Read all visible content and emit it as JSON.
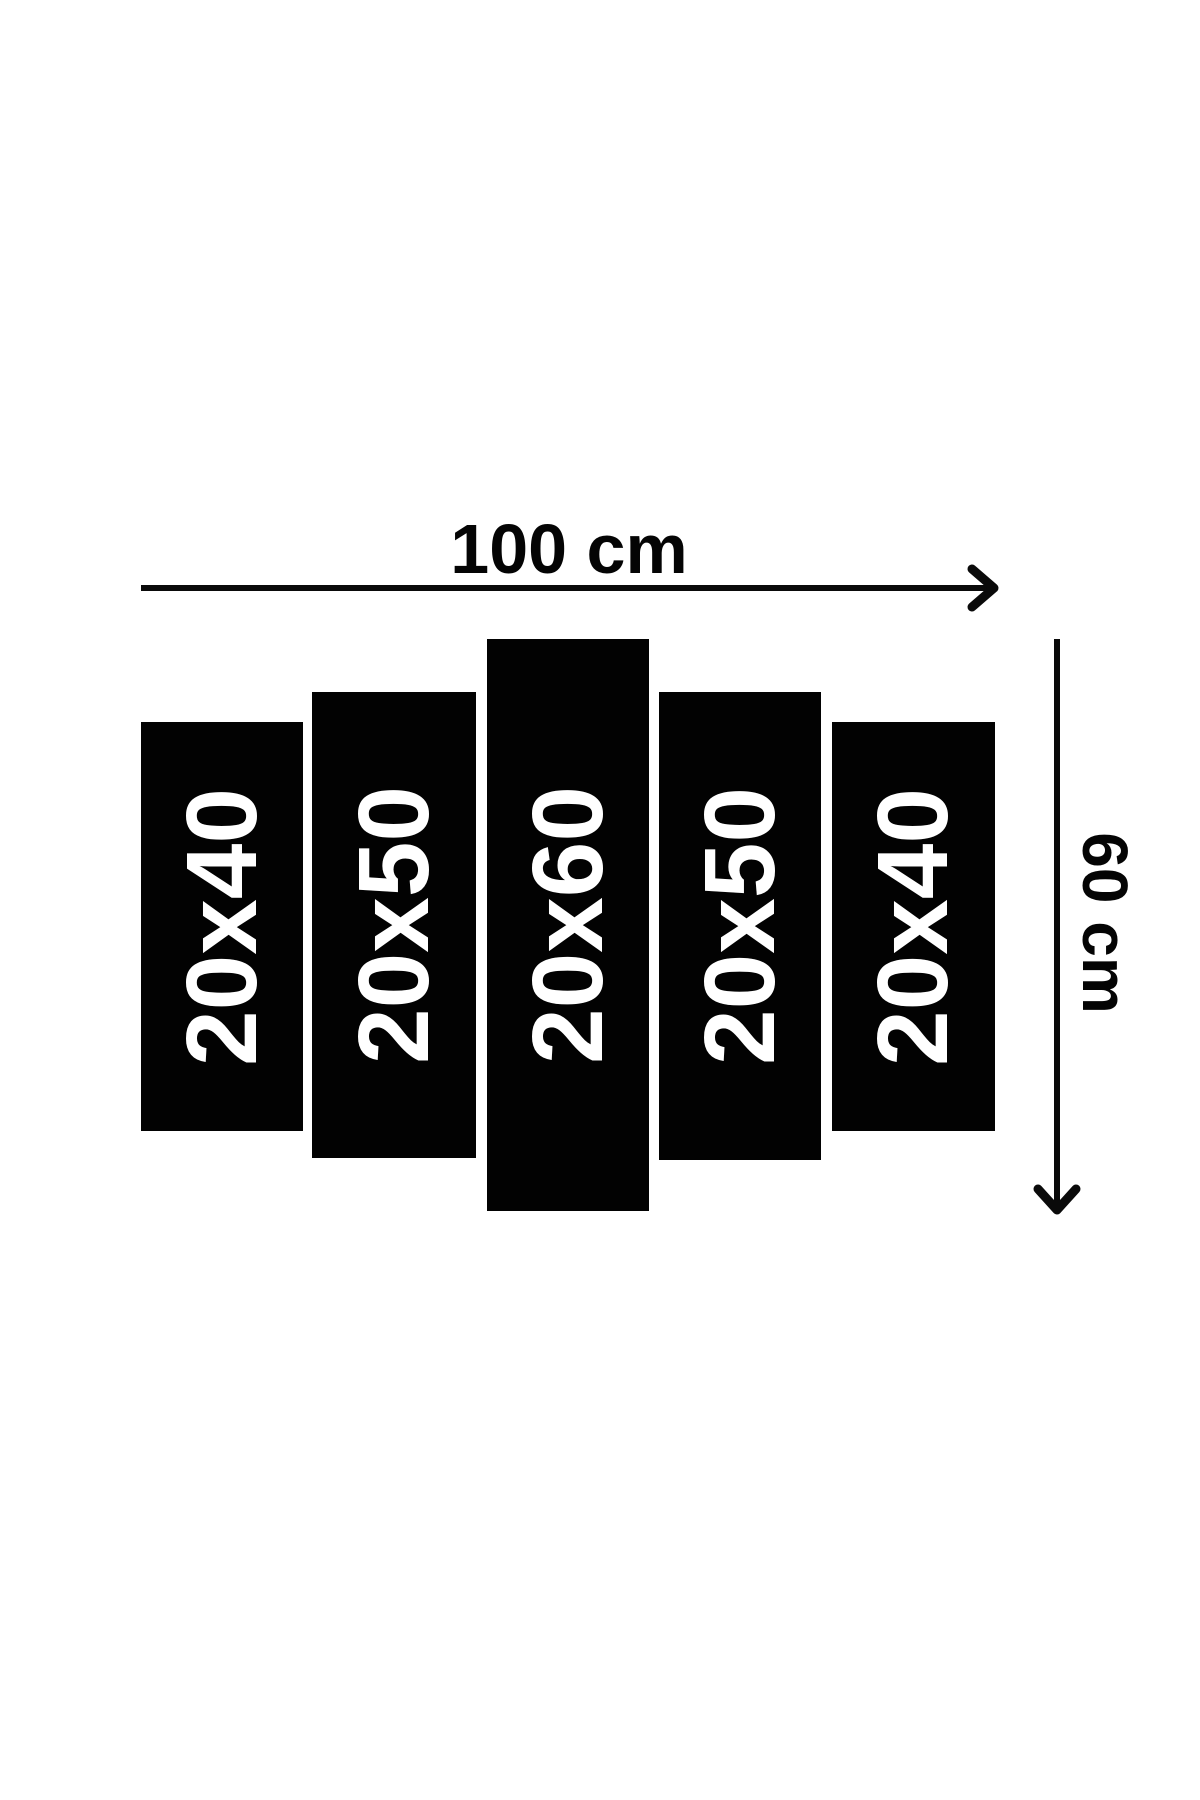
{
  "diagram": {
    "type": "canvas-panel-size-guide",
    "total_width_label": "100 cm",
    "total_height_label": "60 cm"
  },
  "panels": [
    {
      "label": "20x40"
    },
    {
      "label": "20x50"
    },
    {
      "label": "20x60"
    },
    {
      "label": "20x50"
    },
    {
      "label": "20x40"
    }
  ],
  "colors": {
    "background": "#ffffff",
    "panel": "#020202",
    "panel_text": "#ffffff",
    "dimension_text": "#040404",
    "arrow": "#0a0a0a"
  }
}
